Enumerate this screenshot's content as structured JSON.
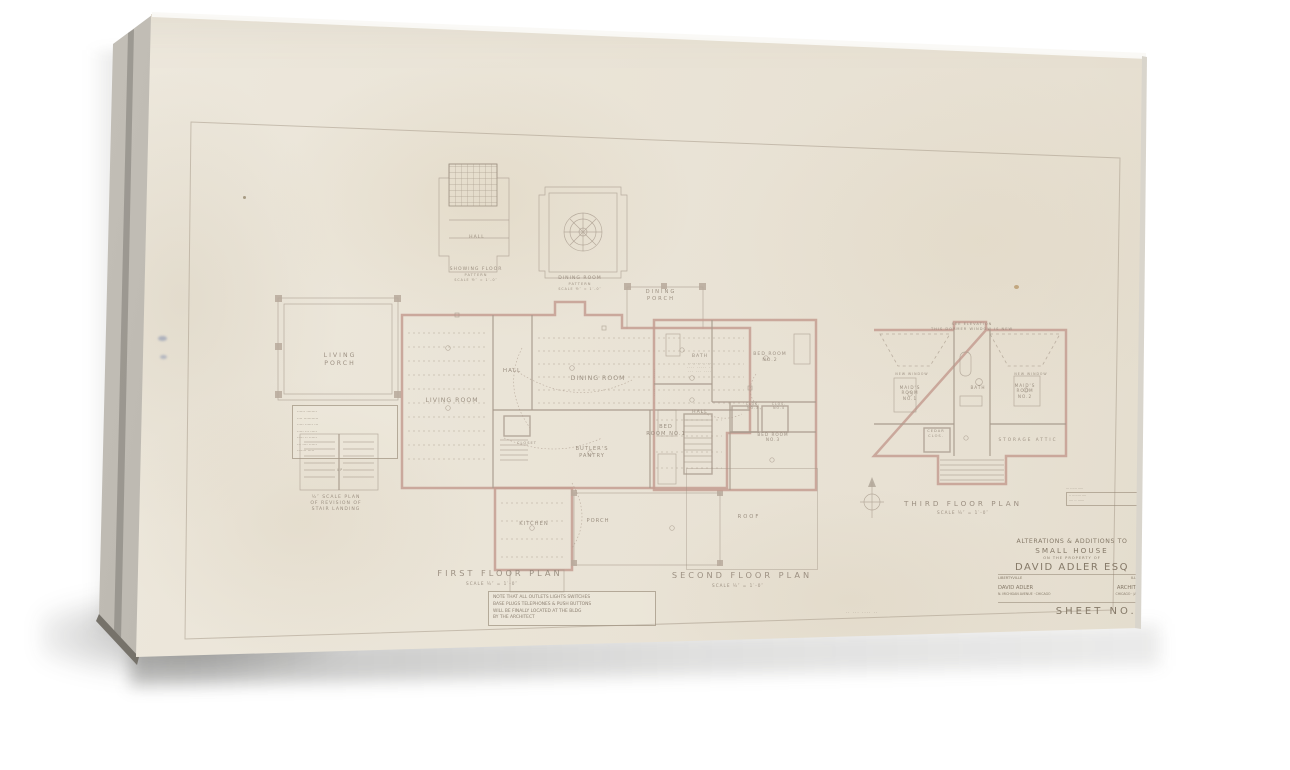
{
  "colors": {
    "paper": "#eae4d7",
    "canvas_side": "#a9a59d",
    "wall_pink": "#c49e92",
    "ink": "#8f8274",
    "shadow": "rgba(40,40,38,0.38)"
  },
  "pattern_plans": {
    "hall": {
      "room_label": "HALL",
      "caption": [
        "SHOWING FLOOR",
        "PATTERN",
        "SCALE ½″ = 1′-0″"
      ]
    },
    "dining": {
      "caption": [
        "DINING ROOM",
        "PATTERN",
        "SCALE ½″ = 1′-0″"
      ]
    },
    "dining_porch": {
      "label": [
        "DINING",
        "PORCH"
      ]
    }
  },
  "first_floor": {
    "title": "FIRST FLOOR PLAN",
    "scale": "SCALE ¼″ = 1′-0″",
    "rooms": {
      "living_porch": [
        "LIVING",
        "PORCH"
      ],
      "living_room": "LIVING ROOM",
      "hall": "HALL",
      "dining_room": "DINING ROOM",
      "closet": "CLOSET",
      "butlers_pantry": [
        "BUTLER'S",
        "PANTRY"
      ],
      "kitchen": "KITCHEN",
      "porch": "PORCH"
    }
  },
  "second_floor": {
    "title": "SECOND FLOOR PLAN",
    "scale": "SCALE ¼″ = 1′-0″",
    "rooms": {
      "bed_room_1": [
        "BED",
        "ROOM NO.1"
      ],
      "bath": "BATH",
      "bed_room_2": [
        "BED ROOM",
        "NO.2"
      ],
      "hall": "HALL",
      "clos_3": [
        "CLOS.",
        "NO.3"
      ],
      "clos_4": [
        "CLOS.",
        "NO.4"
      ],
      "bed_room_3": [
        "BED ROOM",
        "NO.3"
      ],
      "roof": "ROOF"
    }
  },
  "third_floor": {
    "title": "THIRD FLOOR PLAN",
    "scale": "SCALE ¼″ = 1′-0″",
    "rooms": {
      "maids_room_1": [
        "MAID'S",
        "ROOM",
        "NO.1"
      ],
      "bath": "BATH",
      "maids_room_2": [
        "MAID'S",
        "ROOM",
        "NO.2"
      ],
      "cedar_clos": [
        "CEDAR",
        "CLOS."
      ],
      "storage_attic": "STORAGE ATTIC"
    },
    "notes": {
      "see_elevation": [
        "SEE ELEVATION",
        "THIS DORMER WINDOW IS NEW"
      ],
      "new_window_left": "NEW WINDOW",
      "new_window_right": "NEW WINDOW"
    }
  },
  "stair_detail": {
    "caption": [
      "½″ SCALE PLAN",
      "OF REVISION OF",
      "STAIR LANDING"
    ],
    "up": "UP"
  },
  "notes": {
    "left_box": [
      "······ ········",
      "···· ···········",
      "····· ······ ···",
      "····· ··· ·····",
      "····· ·· ······",
      "··· ···· ······",
      "······· ·····"
    ],
    "bottom_box": [
      "NOTE THAT ALL OUTLETS LIGHTS SWITCHES",
      "BASE PLUGS TELEPHONES & PUSH BUTTONS",
      "WILL BE FINALLY LOCATED AT THE BLDG",
      "BY THE ARCHITECT"
    ],
    "stamp": [
      "··· ······ ·····",
      "·· ········ ····",
      "···· ·· ······"
    ],
    "pencil": "·· ··· ···· ··",
    "scribble_v": "···· ··· ·····",
    "bath_note": [
      "········ ···",
      "···· ····· ··",
      "··· ··· ····"
    ]
  },
  "title_block": {
    "line1": "ALTERATIONS & ADDITIONS TO",
    "line2": "SMALL HOUSE",
    "line3": "ON THE PROPERTY OF",
    "name": "DAVID ADLER ESQ",
    "place_left": "LIBERTYVILLE",
    "place_right": "ILLINOIS",
    "arch_left": "DAVID ADLER",
    "arch_right": "ARCHITECT",
    "addr_left": "N. MICHIGAN AVENUE · CHICAGO",
    "addr_right": "CHICAGO · JAN 19··",
    "sheet": "SHEET NO.1"
  }
}
